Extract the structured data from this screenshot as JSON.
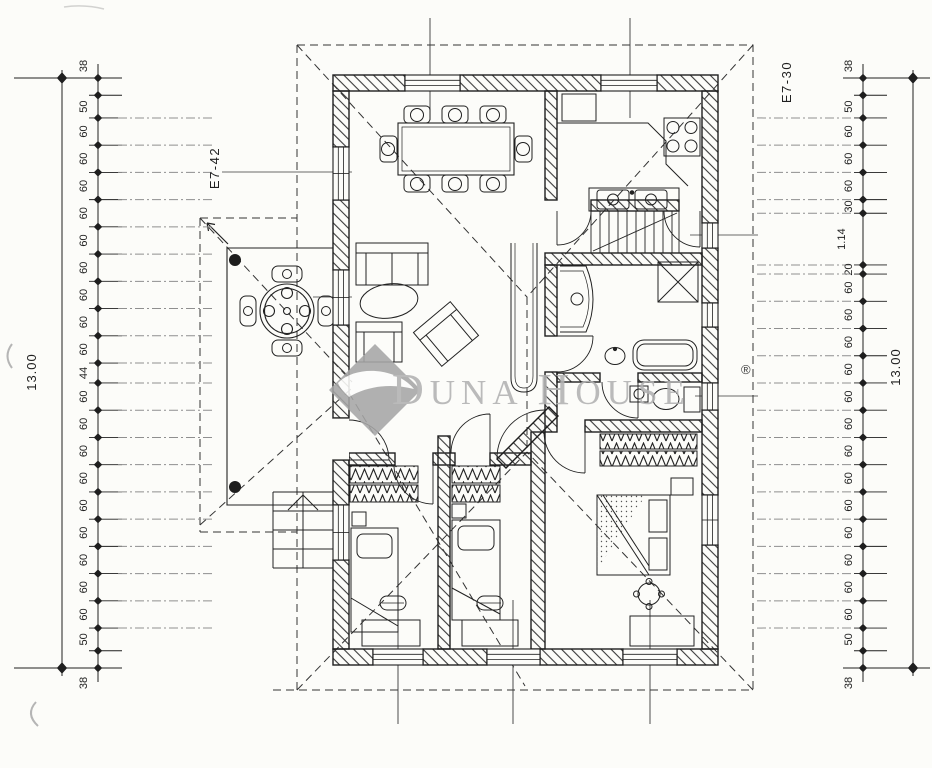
{
  "colors": {
    "paper": "#fcfcf9",
    "ink": "#1f1f1f",
    "leader": "#8f8f8f",
    "watermark": "#b2b2b2"
  },
  "watermark": {
    "brand": "DUNA HOUSE",
    "d": "D",
    "una": "UNA",
    "h": "H",
    "ouse": "OUSE",
    "registered": "®"
  },
  "axis_labels": {
    "left_code": "E7-42",
    "right_code": "E7-30"
  },
  "totals": {
    "left": "13.00",
    "right": "13.00"
  },
  "chains": {
    "left": [
      "38",
      "50",
      "60",
      "60",
      "60",
      "60",
      "60",
      "60",
      "60",
      "60",
      "60",
      "44",
      "60",
      "60",
      "60",
      "60",
      "60",
      "60",
      "60",
      "60",
      "60",
      "50",
      "38"
    ],
    "right": [
      "38",
      "50",
      "60",
      "60",
      "60",
      "30",
      "1.14",
      "20",
      "60",
      "60",
      "60",
      "60",
      "60",
      "60",
      "60",
      "60",
      "60",
      "60",
      "60",
      "60",
      "60",
      "50",
      "38"
    ]
  }
}
